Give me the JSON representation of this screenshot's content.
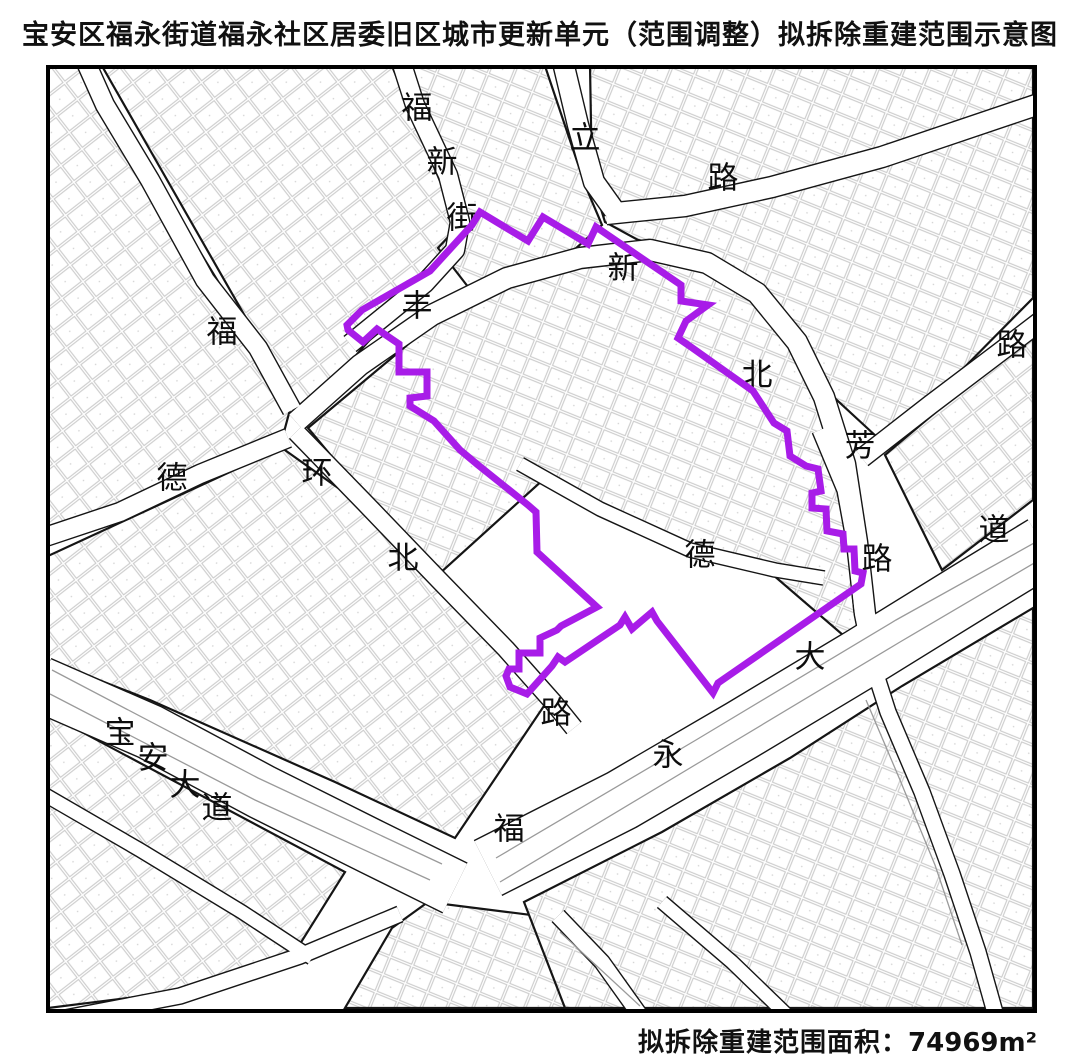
{
  "title": "宝安区福永街道福永社区居委旧区城市更新单元（范围调整）拟拆除重建范围示意图",
  "footer": {
    "label": "拟拆除重建范围面积：",
    "value": "74969",
    "unit": "m²"
  },
  "map": {
    "boundary_color": "#A81CE8",
    "line_color": "#151515",
    "lane_color": "#9a9a9a",
    "boundary_points": [
      [
        480,
        212
      ],
      [
        528,
        241
      ],
      [
        543,
        217
      ],
      [
        588,
        244
      ],
      [
        596,
        227
      ],
      [
        681,
        285
      ],
      [
        681,
        301
      ],
      [
        708,
        305
      ],
      [
        686,
        321
      ],
      [
        678,
        338
      ],
      [
        691,
        347
      ],
      [
        753,
        391
      ],
      [
        774,
        423
      ],
      [
        787,
        431
      ],
      [
        790,
        456
      ],
      [
        806,
        466
      ],
      [
        818,
        469
      ],
      [
        821,
        491
      ],
      [
        812,
        493
      ],
      [
        812,
        508
      ],
      [
        826,
        509
      ],
      [
        827,
        531
      ],
      [
        843,
        534
      ],
      [
        844,
        549
      ],
      [
        854,
        549
      ],
      [
        855,
        571
      ],
      [
        863,
        573
      ],
      [
        861,
        584
      ],
      [
        718,
        683
      ],
      [
        713,
        693
      ],
      [
        657,
        621
      ],
      [
        652,
        612
      ],
      [
        632,
        629
      ],
      [
        625,
        617
      ],
      [
        620,
        625
      ],
      [
        565,
        662
      ],
      [
        558,
        657
      ],
      [
        552,
        666
      ],
      [
        527,
        694
      ],
      [
        510,
        687
      ],
      [
        506,
        676
      ],
      [
        509,
        669
      ],
      [
        519,
        669
      ],
      [
        519,
        653
      ],
      [
        540,
        653
      ],
      [
        540,
        638
      ],
      [
        557,
        630
      ],
      [
        561,
        626
      ],
      [
        597,
        607
      ],
      [
        537,
        552
      ],
      [
        536,
        512
      ],
      [
        528,
        505
      ],
      [
        478,
        465
      ],
      [
        460,
        450
      ],
      [
        434,
        421
      ],
      [
        410,
        406
      ],
      [
        410,
        398
      ],
      [
        427,
        396
      ],
      [
        427,
        372
      ],
      [
        399,
        372
      ],
      [
        399,
        344
      ],
      [
        377,
        329
      ],
      [
        363,
        342
      ],
      [
        348,
        330
      ],
      [
        347,
        325
      ],
      [
        362,
        310
      ],
      [
        430,
        271
      ],
      [
        472,
        225
      ]
    ],
    "labels": [
      {
        "t": "福",
        "x": 417,
        "y": 108
      },
      {
        "t": "新",
        "x": 442,
        "y": 162
      },
      {
        "t": "街",
        "x": 462,
        "y": 218
      },
      {
        "t": "立",
        "x": 585,
        "y": 138
      },
      {
        "t": "路",
        "x": 723,
        "y": 178
      },
      {
        "t": "新",
        "x": 623,
        "y": 268
      },
      {
        "t": "北",
        "x": 757,
        "y": 375
      },
      {
        "t": "路",
        "x": 1012,
        "y": 345
      },
      {
        "t": "丰",
        "x": 417,
        "y": 306
      },
      {
        "t": "福",
        "x": 222,
        "y": 332
      },
      {
        "t": "德",
        "x": 172,
        "y": 478
      },
      {
        "t": "环",
        "x": 317,
        "y": 473
      },
      {
        "t": "北",
        "x": 403,
        "y": 558
      },
      {
        "t": "路",
        "x": 556,
        "y": 713
      },
      {
        "t": "芳",
        "x": 860,
        "y": 446
      },
      {
        "t": "路",
        "x": 877,
        "y": 559
      },
      {
        "t": "德",
        "x": 700,
        "y": 555
      },
      {
        "t": "永",
        "x": 668,
        "y": 755
      },
      {
        "t": "大",
        "x": 810,
        "y": 657
      },
      {
        "t": "道",
        "x": 994,
        "y": 530
      },
      {
        "t": "宝",
        "x": 120,
        "y": 733
      },
      {
        "t": "安",
        "x": 153,
        "y": 758
      },
      {
        "t": "大",
        "x": 185,
        "y": 785
      },
      {
        "t": "道",
        "x": 217,
        "y": 808
      },
      {
        "t": "福",
        "x": 509,
        "y": 829
      }
    ],
    "blocks": [
      {
        "p": 1,
        "pts": [
          [
            48,
            66
          ],
          [
            86,
            66
          ],
          [
            292,
            402
          ],
          [
            284,
            432
          ],
          [
            48,
            536
          ]
        ]
      },
      {
        "p": 1,
        "pts": [
          [
            102,
            66
          ],
          [
            392,
            66
          ],
          [
            452,
            210
          ],
          [
            448,
            252
          ],
          [
            302,
            416
          ]
        ]
      },
      {
        "p": 2,
        "pts": [
          [
            412,
            66
          ],
          [
            545,
            66
          ],
          [
            585,
            185
          ],
          [
            602,
            225
          ],
          [
            565,
            258
          ],
          [
            472,
            292
          ],
          [
            438,
            248
          ],
          [
            462,
            222
          ],
          [
            452,
            208
          ]
        ]
      },
      {
        "p": 2,
        "pts": [
          [
            590,
            66
          ],
          [
            1033,
            66
          ],
          [
            1033,
            298
          ],
          [
            944,
            388
          ],
          [
            878,
            438
          ],
          [
            826,
            390
          ],
          [
            795,
            340
          ],
          [
            748,
            288
          ],
          [
            695,
            252
          ],
          [
            638,
            240
          ],
          [
            605,
            222
          ],
          [
            592,
            180
          ]
        ]
      },
      {
        "p": 2,
        "pts": [
          [
            308,
            428
          ],
          [
            455,
            305
          ],
          [
            585,
            255
          ],
          [
            668,
            250
          ],
          [
            740,
            280
          ],
          [
            795,
            340
          ],
          [
            826,
            408
          ],
          [
            848,
            480
          ],
          [
            860,
            568
          ],
          [
            872,
            660
          ],
          [
            772,
            574
          ],
          [
            660,
            540
          ],
          [
            545,
            478
          ],
          [
            438,
            575
          ],
          [
            368,
            500
          ]
        ]
      },
      {
        "p": 1,
        "pts": [
          [
            885,
            455
          ],
          [
            1033,
            330
          ],
          [
            1033,
            500
          ],
          [
            942,
            570
          ]
        ]
      },
      {
        "p": 1,
        "pts": [
          [
            48,
            556
          ],
          [
            282,
            448
          ],
          [
            362,
            505
          ],
          [
            438,
            582
          ],
          [
            508,
            652
          ],
          [
            548,
            700
          ],
          [
            455,
            838
          ],
          [
            335,
            782
          ],
          [
            150,
            700
          ],
          [
            48,
            660
          ]
        ]
      },
      {
        "p": 1,
        "pts": [
          [
            48,
            714
          ],
          [
            345,
            872
          ],
          [
            295,
            952
          ],
          [
            175,
            992
          ],
          [
            48,
            1008
          ]
        ]
      },
      {
        "p": 2,
        "pts": [
          [
            392,
            928
          ],
          [
            428,
            902
          ],
          [
            555,
            918
          ],
          [
            635,
            1008
          ],
          [
            345,
            1008
          ]
        ]
      },
      {
        "p": 2,
        "pts": [
          [
            524,
            902
          ],
          [
            662,
            832
          ],
          [
            790,
            758
          ],
          [
            902,
            686
          ],
          [
            1033,
            608
          ],
          [
            1033,
            1008
          ],
          [
            565,
            1008
          ]
        ]
      }
    ],
    "roads": [
      {
        "w": 18,
        "pts": [
          [
            400,
            58
          ],
          [
            415,
            105
          ],
          [
            448,
            175
          ],
          [
            460,
            222
          ],
          [
            455,
            250
          ],
          [
            425,
            283
          ],
          [
            382,
            318
          ],
          [
            350,
            344
          ]
        ]
      },
      {
        "w": 18,
        "pts": [
          [
            84,
            58
          ],
          [
            105,
            105
          ],
          [
            150,
            180
          ],
          [
            205,
            280
          ],
          [
            258,
            348
          ],
          [
            292,
            410
          ]
        ]
      },
      {
        "w": 18,
        "pts": [
          [
            42,
            538
          ],
          [
            120,
            512
          ],
          [
            200,
            474
          ],
          [
            288,
            438
          ]
        ]
      },
      {
        "w": 20,
        "pts": [
          [
            296,
            422
          ],
          [
            360,
            365
          ],
          [
            432,
            315
          ],
          [
            507,
            278
          ],
          [
            580,
            258
          ],
          [
            650,
            250
          ],
          [
            707,
            263
          ],
          [
            757,
            293
          ],
          [
            797,
            342
          ],
          [
            824,
            397
          ],
          [
            845,
            464
          ],
          [
            857,
            542
          ],
          [
            865,
            614
          ],
          [
            874,
            658
          ]
        ]
      },
      {
        "w": 20,
        "pts": [
          [
            562,
            58
          ],
          [
            578,
            125
          ],
          [
            594,
            182
          ],
          [
            614,
            210
          ]
        ]
      },
      {
        "w": 20,
        "pts": [
          [
            606,
            214
          ],
          [
            685,
            206
          ],
          [
            772,
            187
          ],
          [
            882,
            157
          ],
          [
            1042,
            103
          ]
        ]
      },
      {
        "w": 18,
        "pts": [
          [
            862,
            458
          ],
          [
            930,
            405
          ],
          [
            1000,
            352
          ],
          [
            1042,
            320
          ]
        ]
      },
      {
        "w": 15,
        "pts": [
          [
            820,
            430
          ],
          [
            845,
            490
          ],
          [
            856,
            550
          ],
          [
            862,
            610
          ],
          [
            872,
            662
          ],
          [
            888,
            712
          ],
          [
            922,
            792
          ],
          [
            952,
            874
          ],
          [
            978,
            952
          ],
          [
            996,
            1016
          ]
        ]
      },
      {
        "w": 13,
        "pts": [
          [
            520,
            464
          ],
          [
            600,
            509
          ],
          [
            690,
            550
          ],
          [
            775,
            570
          ],
          [
            824,
            578
          ]
        ]
      },
      {
        "w": 17,
        "pts": [
          [
            296,
            432
          ],
          [
            365,
            503
          ],
          [
            438,
            579
          ],
          [
            506,
            649
          ],
          [
            553,
            702
          ],
          [
            574,
            728
          ]
        ]
      },
      {
        "w": 54,
        "pts": [
          [
            40,
            684
          ],
          [
            150,
            732
          ],
          [
            262,
            792
          ],
          [
            372,
            847
          ],
          [
            455,
            888
          ]
        ]
      },
      {
        "w": 60,
        "pts": [
          [
            488,
            868
          ],
          [
            622,
            800
          ],
          [
            742,
            730
          ],
          [
            862,
            658
          ],
          [
            972,
            590
          ],
          [
            1044,
            546
          ]
        ]
      },
      {
        "w": 15,
        "pts": [
          [
            400,
            914
          ],
          [
            300,
            956
          ],
          [
            180,
            996
          ],
          [
            55,
            1020
          ]
        ]
      },
      {
        "w": 13,
        "pts": [
          [
            40,
            792
          ],
          [
            140,
            850
          ],
          [
            242,
            912
          ],
          [
            312,
            958
          ]
        ]
      },
      {
        "w": 15,
        "pts": [
          [
            558,
            916
          ],
          [
            602,
            962
          ],
          [
            642,
            1018
          ]
        ]
      },
      {
        "w": 13,
        "pts": [
          [
            662,
            902
          ],
          [
            732,
            962
          ],
          [
            792,
            1020
          ]
        ]
      }
    ],
    "lane_lines": [
      [
        [
          50,
          694
        ],
        [
          255,
          800
        ],
        [
          430,
          880
        ]
      ],
      [
        [
          52,
          670
        ],
        [
          258,
          778
        ],
        [
          442,
          864
        ]
      ],
      [
        [
          500,
          882
        ],
        [
          700,
          762
        ],
        [
          900,
          642
        ],
        [
          1036,
          562
        ]
      ],
      [
        [
          496,
          858
        ],
        [
          696,
          740
        ],
        [
          896,
          620
        ],
        [
          1036,
          542
        ]
      ],
      [
        [
          560,
          932
        ],
        [
          640,
          1006
        ]
      ],
      [
        [
          866,
          700
        ],
        [
          900,
          780
        ],
        [
          935,
          865
        ],
        [
          962,
          945
        ]
      ]
    ]
  }
}
